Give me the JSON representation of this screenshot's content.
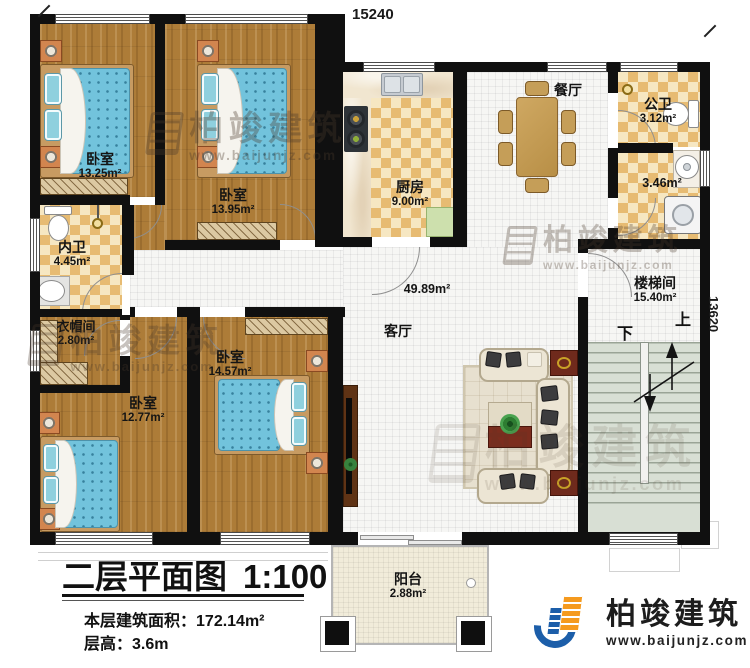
{
  "plan": {
    "title": "二层平面图",
    "scale": "1:100",
    "area_label": "本层建筑面积：",
    "area_value": "172.14m²",
    "height_label": "层高：",
    "height_value": "3.6m"
  },
  "dimensions": {
    "top_width": "15240",
    "right_height": "13620"
  },
  "rooms": {
    "bedroom_a": {
      "label": "卧室",
      "area": "13.25m²"
    },
    "bedroom_b": {
      "label": "卧室",
      "area": "13.95m²"
    },
    "bedroom_c": {
      "label": "卧室",
      "area": "12.77m²"
    },
    "bedroom_d": {
      "label": "卧室",
      "area": "14.57m²"
    },
    "kitchen": {
      "label": "厨房",
      "area": "9.00m²"
    },
    "dining": {
      "label": "餐厅"
    },
    "living": {
      "label": "客厅",
      "area": "49.89m²"
    },
    "inner_bath": {
      "label": "内卫",
      "area": "4.45m²"
    },
    "cloakroom": {
      "label": "衣帽间",
      "area": "2.80m²"
    },
    "public_bath": {
      "label": "公卫",
      "area": "3.12m²"
    },
    "wash_area": {
      "area": "3.46m²"
    },
    "stairwell": {
      "label": "楼梯间",
      "area": "15.40m²"
    },
    "balcony": {
      "label": "阳台",
      "area": "2.88m²"
    }
  },
  "stairs": {
    "up": "上",
    "down": "下"
  },
  "brand": {
    "name": "柏竣建筑",
    "url": "www.baijunjz.com"
  },
  "colors": {
    "wall": "#101010",
    "wood": "#ad7c38",
    "tile_accent": "#e7bb72",
    "brand_blue": "#1c5ea9",
    "brand_orange": "#f59a1e"
  }
}
